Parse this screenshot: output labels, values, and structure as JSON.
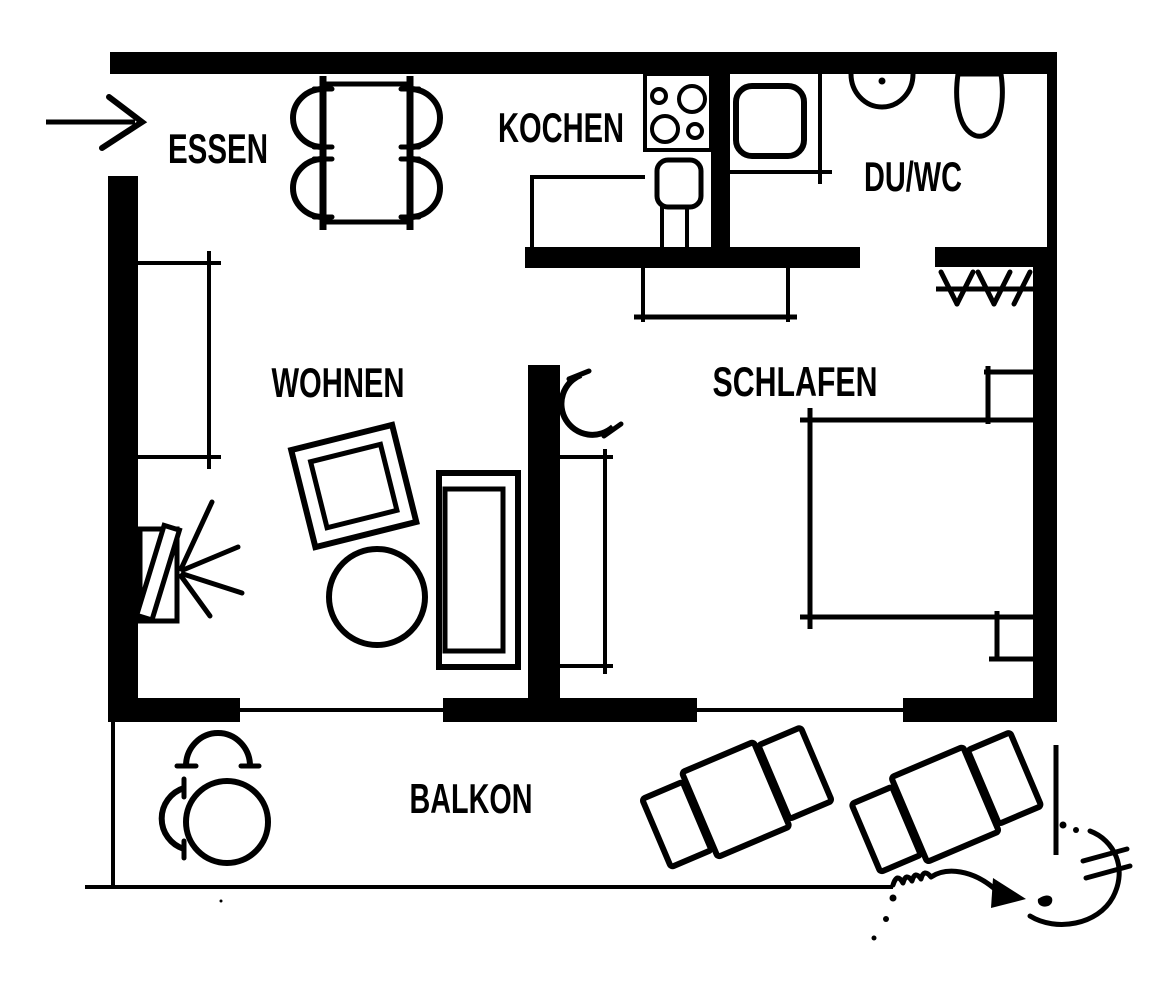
{
  "floorplan": {
    "type": "apartment-floor-plan",
    "language": "de",
    "ink_color": "#000000",
    "background_color": "#ffffff",
    "rooms": [
      {
        "id": "essen",
        "label": "ESSEN"
      },
      {
        "id": "kochen",
        "label": "KOCHEN"
      },
      {
        "id": "duwc",
        "label": "DU/WC"
      },
      {
        "id": "wohnen",
        "label": "WOHNEN"
      },
      {
        "id": "schlafen",
        "label": "SCHLAFEN"
      },
      {
        "id": "balkon",
        "label": "BALKON"
      }
    ],
    "symbols": [
      "entrance-arrow",
      "dining-table-with-4-chairs",
      "stove-4-burners",
      "kitchen-sink",
      "shower-tray",
      "washbasin",
      "toilet",
      "coat-rack",
      "hall-dresser",
      "sideboard",
      "tv-with-viewing-rays",
      "armchair",
      "round-coffee-table",
      "sofa",
      "door-swing-arc",
      "wardrobe",
      "double-bed",
      "nightstand",
      "balcony-table-with-2-chairs",
      "sun-lounger",
      "hand-drawn-doodle"
    ]
  }
}
